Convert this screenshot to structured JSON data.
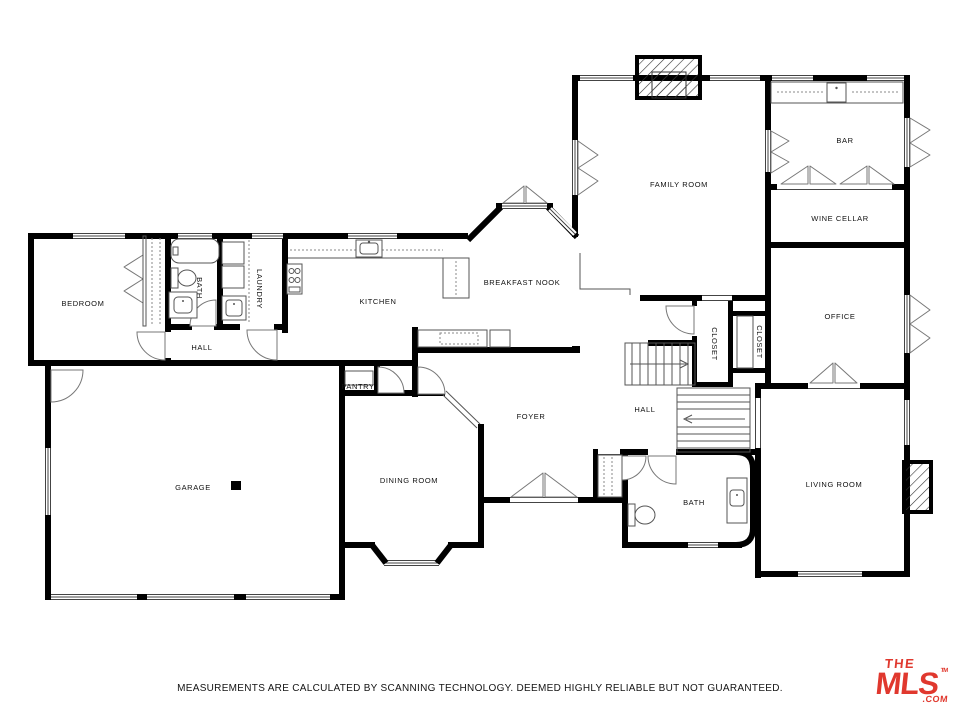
{
  "rooms": {
    "bedroom": {
      "label": "BEDROOM"
    },
    "bath1": {
      "label": "BATH"
    },
    "laundry": {
      "label": "LAUNDRY"
    },
    "hall1": {
      "label": "HALL"
    },
    "kitchen": {
      "label": "KITCHEN"
    },
    "breakfast_nook": {
      "label": "BREAKFAST NOOK"
    },
    "family_room": {
      "label": "FAMILY ROOM"
    },
    "bar": {
      "label": "BAR"
    },
    "wine_cellar": {
      "label": "WINE CELLAR"
    },
    "office": {
      "label": "OFFICE"
    },
    "closet1": {
      "label": "CLOSET"
    },
    "closet2": {
      "label": "CLOSET"
    },
    "pantry": {
      "label": "PANTRY"
    },
    "foyer": {
      "label": "FOYER"
    },
    "hall2": {
      "label": "HALL"
    },
    "garage": {
      "label": "GARAGE"
    },
    "dining_room": {
      "label": "DINING ROOM"
    },
    "bath2": {
      "label": "BATH"
    },
    "living_room": {
      "label": "LIVING ROOM"
    }
  },
  "footer": {
    "disclaimer": "MEASUREMENTS ARE CALCULATED BY SCANNING TECHNOLOGY. DEEMED HIGHLY RELIABLE BUT NOT GUARANTEED."
  },
  "logo": {
    "line1": "THE",
    "line2": "MLS",
    "tm": "TM",
    "suffix": ".COM",
    "color": "#e0382e"
  },
  "colors": {
    "wall": "#000000",
    "fixture_line": "#555555"
  }
}
